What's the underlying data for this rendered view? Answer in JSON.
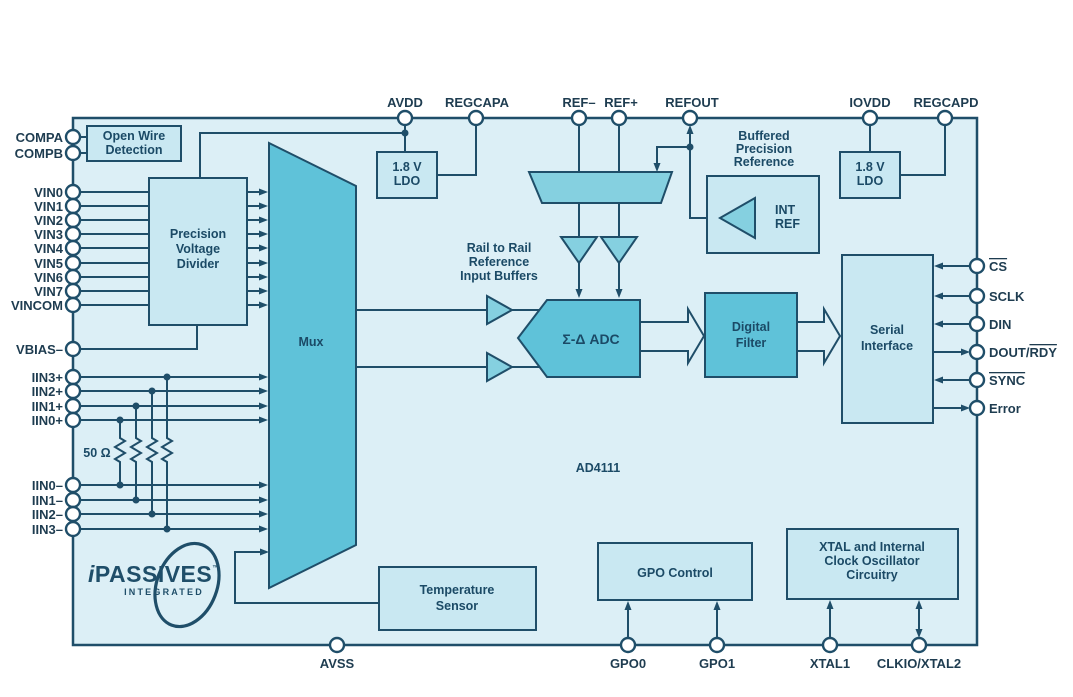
{
  "diagram": {
    "part_number": "AD4111"
  },
  "pins": {
    "top": [
      "AVDD",
      "REGCAPA",
      "REF–",
      "REF+",
      "REFOUT",
      "IOVDD",
      "REGCAPD"
    ],
    "left": [
      "COMPA",
      "COMPB",
      "VIN0",
      "VIN1",
      "VIN2",
      "VIN3",
      "VIN4",
      "VIN5",
      "VIN6",
      "VIN7",
      "VINCOM",
      "VBIAS–",
      "IIN3+",
      "IIN2+",
      "IIN1+",
      "IIN0+",
      "IIN0–",
      "IIN1–",
      "IIN2–",
      "IIN3–"
    ],
    "right": {
      "cs": "CS",
      "sclk": "SCLK",
      "din": "DIN",
      "dout_prefix": "DOUT/",
      "dout_overline": "RDY",
      "sync": "SYNC",
      "error": "Error"
    },
    "bottom": [
      "AVSS",
      "GPO0",
      "GPO1",
      "XTAL1",
      "CLKIO/XTAL2"
    ]
  },
  "blocks": {
    "open_wire_detection": [
      "Open Wire",
      "Detection"
    ],
    "precision_voltage_divider": [
      "Precision",
      "Voltage",
      "Divider"
    ],
    "ldo_analog": [
      "1.8 V",
      "LDO"
    ],
    "ldo_digital": [
      "1.8 V",
      "LDO"
    ],
    "mux": "Mux",
    "adc": "Σ-Δ ADC",
    "digital_filter": [
      "Digital",
      "Filter"
    ],
    "serial_interface": [
      "Serial",
      "Interface"
    ],
    "temperature_sensor": [
      "Temperature",
      "Sensor"
    ],
    "gpo_control": "GPO Control",
    "xtal_oscillator": [
      "XTAL and Internal",
      "Clock Oscillator",
      "Circuitry"
    ],
    "int_ref": [
      "INT",
      "REF"
    ]
  },
  "annotations": {
    "buffered_reference": [
      "Buffered",
      "Precision",
      "Reference"
    ],
    "rail_to_rail": [
      "Rail to Rail",
      "Reference",
      "Input Buffers"
    ],
    "resistor_value": "50 Ω",
    "part_label": "AD4111"
  },
  "logo": {
    "prefix": "i",
    "name": "PASSIVES",
    "tm": "™",
    "subtitle": "INTEGRATED"
  },
  "colors": {
    "background": "#ffffff",
    "chip_fill": "#dceff6",
    "block_fill": "#c9e8f2",
    "shape_fill": "#5fc2d9",
    "shape_fill_light": "#85d0e0",
    "line": "#1f4e69",
    "text": "#1b4a66",
    "pin_text": "#1e3c50"
  }
}
